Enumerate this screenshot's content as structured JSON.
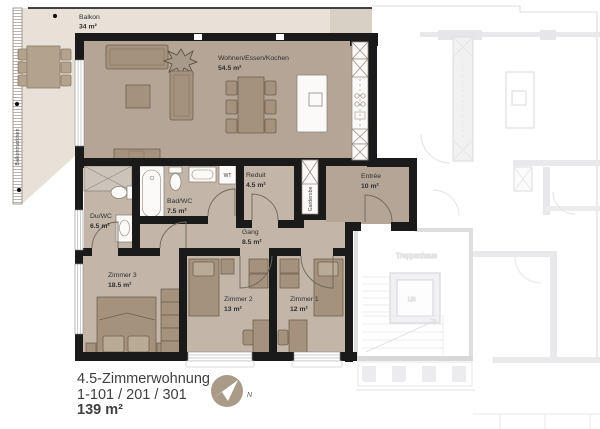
{
  "plan": {
    "rooms": {
      "balkon": {
        "name": "Balkon",
        "area": "34 m²"
      },
      "wohnen": {
        "name": "Wohnen/Essen/Kochen",
        "area": "54.5 m²"
      },
      "reduit": {
        "name": "Reduit",
        "area": "4.5 m²"
      },
      "entree": {
        "name": "Entrée",
        "area": "10 m²"
      },
      "bad": {
        "name": "Bad/WC",
        "area": "7.5 m²"
      },
      "du": {
        "name": "Du/WC",
        "area": "6.5 m²"
      },
      "gang": {
        "name": "Gang",
        "area": "8.5 m²"
      },
      "zimmer3": {
        "name": "Zimmer 3",
        "area": "18.5 m²"
      },
      "zimmer2": {
        "name": "Zimmer 2",
        "area": "13 m²"
      },
      "zimmer1": {
        "name": "Zimmer 1",
        "area": "12 m²"
      }
    },
    "annotations": {
      "balkonmarkisen": "Balkonmarkisen",
      "garderobe": "Garderobe",
      "wt": "WT"
    },
    "neighbor": {
      "treppenhaus": "Treppenhaus",
      "lift": "Lift"
    }
  },
  "legend": {
    "title": "4.5-Zimmerwohnung",
    "units": "1-101 / 201 / 301",
    "total_area": "139 m²",
    "north_label": "N"
  },
  "colors": {
    "wall": "#1a1a1a",
    "floor_living": "#b4a597",
    "floor_rooms": "#c3b6a9",
    "balcony": "#e7e1d7",
    "terrace": "#d8d0c5",
    "furniture": "#a5927e",
    "furniture_outline": "#6f604e",
    "fixture_white": "#fbfaf8",
    "neighbor_line": "#e3e3e5",
    "compass": "#a99b87"
  }
}
